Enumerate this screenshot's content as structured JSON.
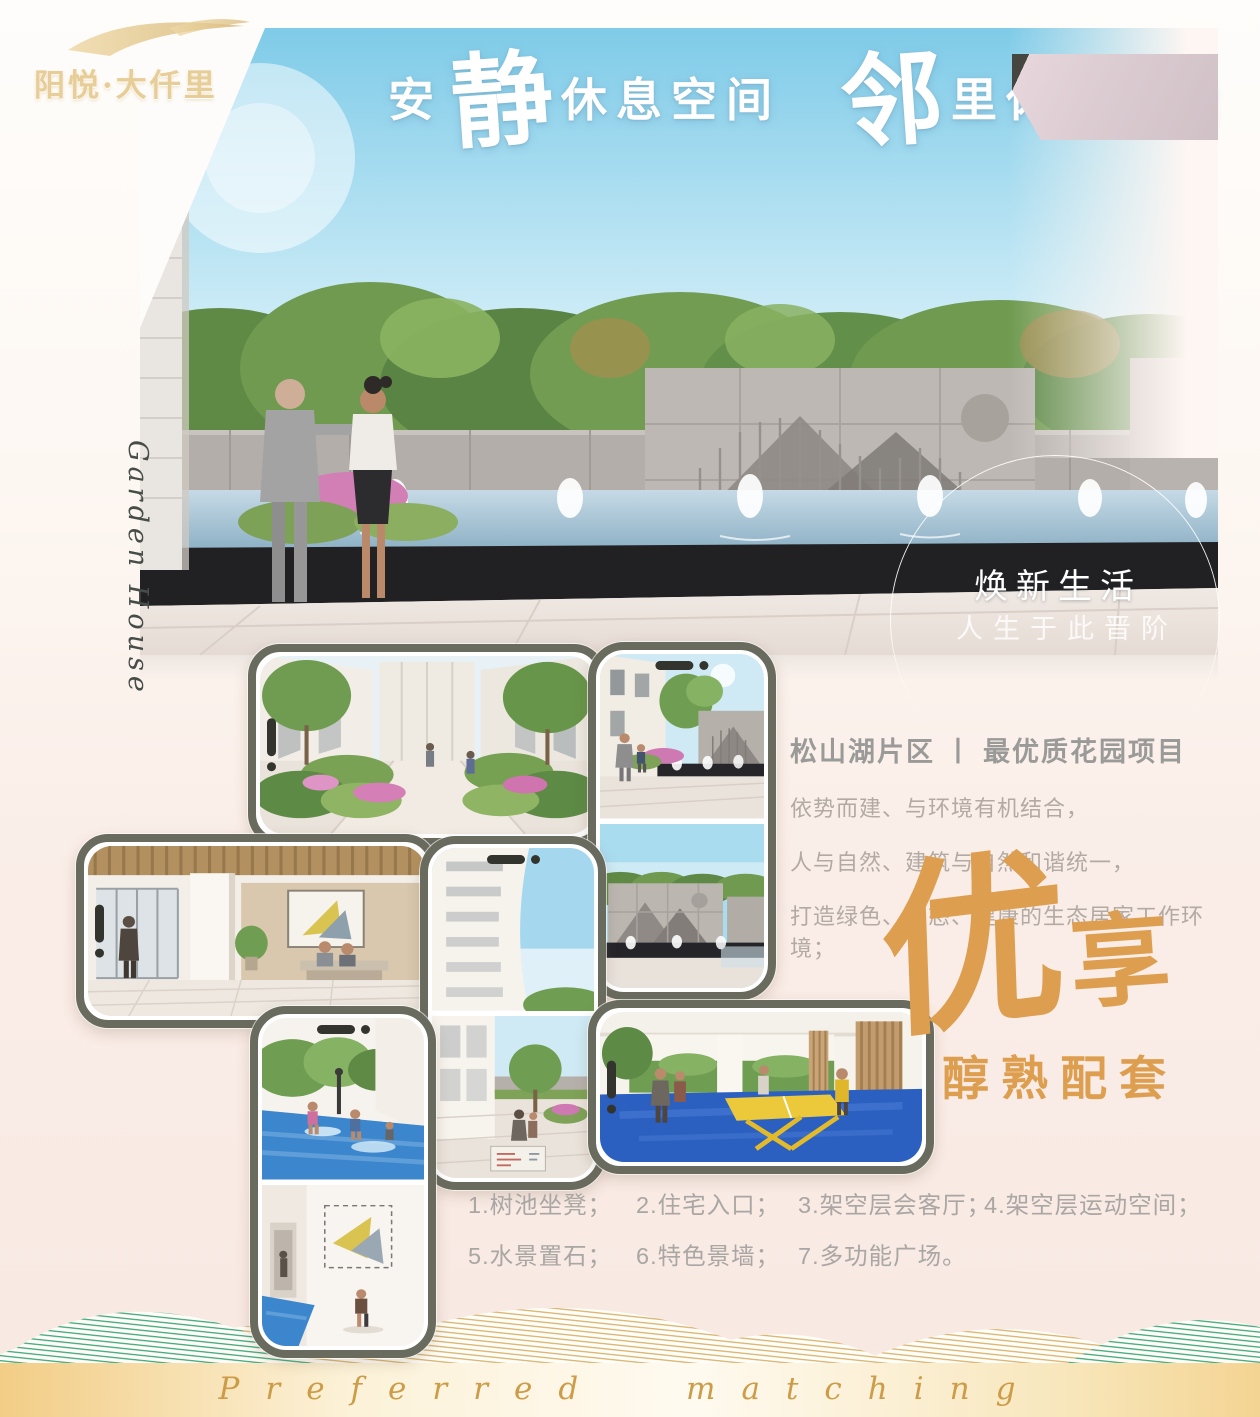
{
  "logo": {
    "text": "阳悦·大仟里"
  },
  "hero": {
    "title": {
      "s1": "安",
      "s2": "静",
      "s3": "休息空间",
      "s4": "邻",
      "s5": "里休闲生活"
    },
    "badge": {
      "line1": "焕新生活",
      "line2": "人生于此晋阶"
    }
  },
  "script_text": "Garden House",
  "section": {
    "title": "松山湖片区 丨 最优质花园项目",
    "lines": [
      "依势而建、与环境有机结合，",
      "人与自然、建筑与自然和谐统一，",
      "打造绿色、生态、健康的生态居家工作环境；"
    ]
  },
  "feature": {
    "char1": "优",
    "char2": "享",
    "subtitle": "醇熟配套"
  },
  "list": {
    "rows": [
      [
        "1.树池坐凳；",
        "2.住宅入口；",
        "3.架空层会客厅；",
        "4.架空层运动空间；"
      ],
      [
        "5.水景置石；",
        "6.特色景墙；",
        "7.多功能广场。"
      ]
    ]
  },
  "footer": {
    "english": "Preferred matching"
  },
  "colors": {
    "accent_gold": "#dd9f4f",
    "title_gray": "#9a9a98",
    "text_gray": "#b3aaa4",
    "mountain_green": "#2fa171",
    "mountain_gold": "#d5ae62",
    "sky_blue": "#7fcbe8"
  }
}
